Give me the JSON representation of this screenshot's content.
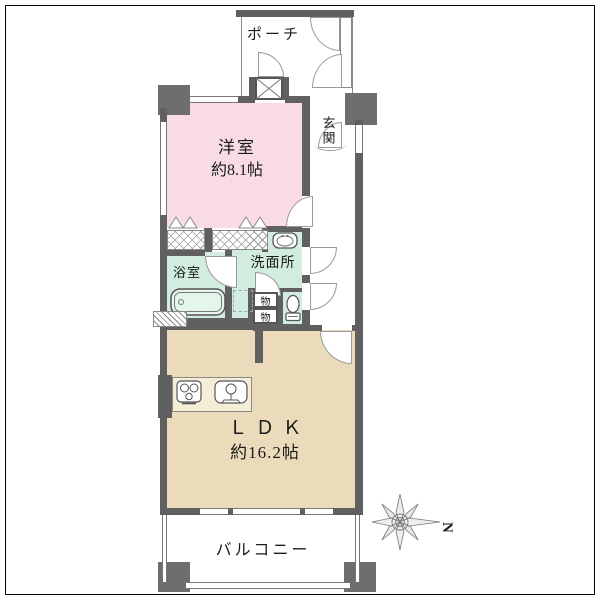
{
  "floorplan": {
    "rooms": {
      "porch": {
        "label": "ポーチ"
      },
      "entrance": {
        "label": "玄関"
      },
      "western_room": {
        "label": "洋室",
        "size": "約8.1帖"
      },
      "bathroom": {
        "label": "浴室"
      },
      "washroom": {
        "label": "洗面所"
      },
      "storage_upper": {
        "label": "物"
      },
      "storage_lower": {
        "label": "物"
      },
      "ldk": {
        "label": "ＬＤＫ",
        "size": "約16.2帖"
      },
      "balcony": {
        "label": "バルコニー"
      }
    },
    "compass": {
      "north_label": "N"
    },
    "colors": {
      "western_room_fill": "#f9dbe3",
      "wet_area_fill": "#d2ecdf",
      "ldk_fill": "#ecdbba",
      "wall": "#606060",
      "pillar": "#6e6e6e",
      "line": "#8a8a8a",
      "background": "#ffffff"
    }
  }
}
